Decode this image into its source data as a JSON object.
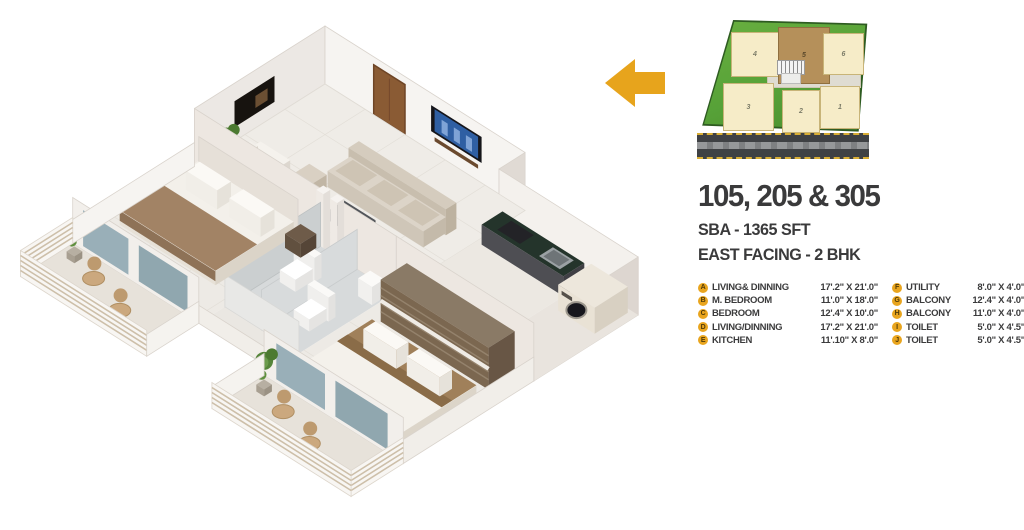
{
  "panel": {
    "title": "105, 205 & 305",
    "sba": "SBA - 1365 SFT",
    "facing": "EAST FACING - 2 BHK"
  },
  "legend": [
    {
      "key": "A",
      "label": "LIVING& DINNING",
      "dim": "17'.2\" X 21'.0\""
    },
    {
      "key": "B",
      "label": "M. BEDROOM",
      "dim": "11'.0\" X 18'.0\""
    },
    {
      "key": "C",
      "label": "BEDROOM",
      "dim": "12'.4\" X 10'.0\""
    },
    {
      "key": "D",
      "label": "LIVING/DINNING",
      "dim": "17'.2\" X 21'.0\""
    },
    {
      "key": "E",
      "label": "KITCHEN",
      "dim": "11'.10\" X 8'.0\""
    },
    {
      "key": "F",
      "label": "UTILITY",
      "dim": "8'.0\" X 4'.0\""
    },
    {
      "key": "G",
      "label": "BALCONY",
      "dim": "12'.4\" X 4'.0\""
    },
    {
      "key": "H",
      "label": "BALCONY",
      "dim": "11'.0\" X 4'.0\""
    },
    {
      "key": "I",
      "label": "TOILET",
      "dim": "5'.0\" X 4'.5\""
    },
    {
      "key": "J",
      "label": "TOILET",
      "dim": "5'.0\" X 4'.5\""
    }
  ],
  "site_plan": {
    "unit_labels": [
      "4",
      "5",
      "6",
      "3",
      "2",
      "1"
    ],
    "highlighted_unit": "5"
  },
  "floor_plan": {
    "type": "3d-isometric-floor-plan",
    "rooms_depicted": [
      "living-dining",
      "kitchen",
      "utility",
      "m-bedroom",
      "toilets",
      "bedroom",
      "balcony-1",
      "balcony-2"
    ]
  },
  "colors": {
    "accent_gold": "#E7A41C",
    "heading_text": "#3A3A3B",
    "site_grass": "#57A238",
    "site_unit": "#F6ECC8",
    "site_unit_highlight": "#B5905A",
    "road": "#3F4144"
  }
}
